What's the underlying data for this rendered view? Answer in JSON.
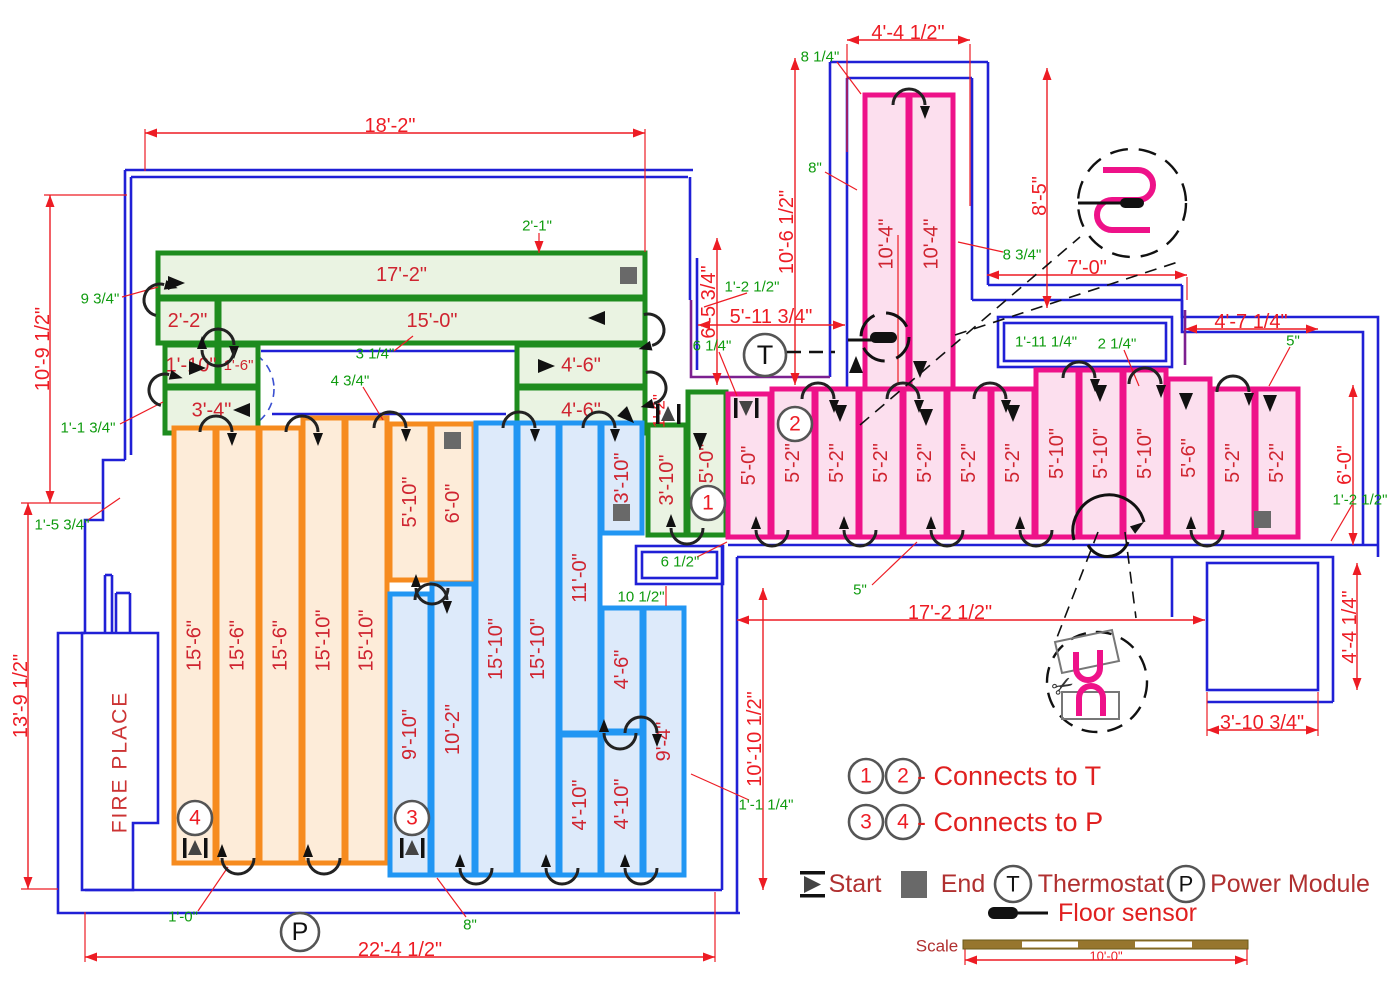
{
  "meta": {
    "width": 1400,
    "height": 1000,
    "type": "floor-heating-plan"
  },
  "colors": {
    "wall": "#2020d6",
    "purple": "#7c2090",
    "dim_red": "#ed1c24",
    "note_green": "#0f9b0f",
    "run_label": "#cf2430",
    "legend_text": "#b03030",
    "legend_red": "#e02020",
    "green_zone": "#1e8c1e",
    "green_fill": "#eaf3e2",
    "orange_zone": "#f68b1f",
    "orange_fill": "#fdecd9",
    "blue_zone": "#2196f3",
    "blue_fill": "#ddeafa",
    "pink_zone": "#ee1289",
    "pink_fill": "#fcdfee",
    "marker_gray": "#555555",
    "end_gray": "#696969",
    "scale_bar": "#97762e",
    "scale_text": "#b03030"
  },
  "fireplace": {
    "label": "FIRE PLACE",
    "x": 120,
    "y": 762
  },
  "zones": {
    "green": {
      "runs": [
        {
          "label": "17'-2\"",
          "x": 158,
          "y": 253,
          "w": 487,
          "h": 44,
          "rot": 0
        },
        {
          "label": "15'-0\"",
          "x": 219,
          "y": 299,
          "w": 426,
          "h": 44,
          "rot": 0
        },
        {
          "label": "2'-2\"",
          "x": 158,
          "y": 299,
          "w": 59,
          "h": 44,
          "rot": 0
        },
        {
          "label": "1'-10\"",
          "x": 165,
          "y": 345,
          "w": 52,
          "h": 41,
          "rot": 0
        },
        {
          "label": "1'-6\"",
          "x": 219,
          "y": 345,
          "w": 39,
          "h": 41,
          "rot": 0
        },
        {
          "label": "3'-4\"",
          "x": 165,
          "y": 388,
          "w": 93,
          "h": 45,
          "rot": 0
        },
        {
          "label": "4'-6\"",
          "x": 517,
          "y": 345,
          "w": 128,
          "h": 41,
          "rot": 0
        },
        {
          "label": "4'-6\"",
          "x": 517,
          "y": 388,
          "w": 128,
          "h": 45,
          "rot": 0
        },
        {
          "label": "3'-10\"",
          "x": 648,
          "y": 425,
          "w": 38,
          "h": 110,
          "rot": -90
        },
        {
          "label": "5'-0\"",
          "x": 688,
          "y": 392,
          "w": 38,
          "h": 143,
          "rot": -90
        }
      ]
    },
    "orange": {
      "runs": [
        {
          "label": "15'-6\"",
          "x": 174,
          "y": 428,
          "w": 41,
          "h": 435,
          "rot": -90
        },
        {
          "label": "15'-6\"",
          "x": 217,
          "y": 428,
          "w": 41,
          "h": 435,
          "rot": -90
        },
        {
          "label": "15'-6\"",
          "x": 260,
          "y": 428,
          "w": 41,
          "h": 435,
          "rot": -90
        },
        {
          "label": "15'-10\"",
          "x": 303,
          "y": 418,
          "w": 41,
          "h": 445,
          "rot": -90
        },
        {
          "label": "15'-10\"",
          "x": 346,
          "y": 418,
          "w": 41,
          "h": 445,
          "rot": -90
        },
        {
          "label": "5'-10\"",
          "x": 390,
          "y": 424,
          "w": 40,
          "h": 156,
          "rot": -90
        },
        {
          "label": "6'-0\"",
          "x": 432,
          "y": 424,
          "w": 42,
          "h": 159,
          "rot": -90
        }
      ]
    },
    "blue": {
      "runs": [
        {
          "label": "9'-10\"",
          "x": 390,
          "y": 594,
          "w": 40,
          "h": 281,
          "rot": -90
        },
        {
          "label": "10'-2\"",
          "x": 432,
          "y": 584,
          "w": 42,
          "h": 291,
          "rot": -90
        },
        {
          "label": "15'-10\"",
          "x": 476,
          "y": 423,
          "w": 40,
          "h": 452,
          "rot": -90
        },
        {
          "label": "15'-10\"",
          "x": 518,
          "y": 423,
          "w": 40,
          "h": 452,
          "rot": -90
        },
        {
          "label": "11'-0\"",
          "x": 560,
          "y": 423,
          "w": 40,
          "h": 310,
          "rot": -90
        },
        {
          "label": "4'-10\"",
          "x": 560,
          "y": 735,
          "w": 40,
          "h": 140,
          "rot": -90
        },
        {
          "label": "3'-10\"",
          "x": 602,
          "y": 423,
          "w": 40,
          "h": 110,
          "rot": -90
        },
        {
          "label": "4'-6\"",
          "x": 602,
          "y": 608,
          "w": 40,
          "h": 123,
          "rot": -90
        },
        {
          "label": "4'-10\"",
          "x": 602,
          "y": 733,
          "w": 40,
          "h": 142,
          "rot": -90
        },
        {
          "label": "9'-4\"",
          "x": 644,
          "y": 608,
          "w": 40,
          "h": 267,
          "rot": -90
        }
      ]
    },
    "pink": {
      "runs": [
        {
          "label": "10'-4\"",
          "x": 865,
          "y": 95,
          "w": 43,
          "h": 298,
          "rot": -90
        },
        {
          "label": "10'-4\"",
          "x": 910,
          "y": 95,
          "w": 43,
          "h": 298,
          "rot": -90
        },
        {
          "label": "5'-0\"",
          "x": 728,
          "y": 394,
          "w": 42,
          "h": 143,
          "rot": -90
        },
        {
          "label": "5'-2\"",
          "x": 772,
          "y": 389,
          "w": 42,
          "h": 148,
          "rot": -90
        },
        {
          "label": "5'-2\"",
          "x": 816,
          "y": 389,
          "w": 42,
          "h": 148,
          "rot": -90
        },
        {
          "label": "5'-2\"",
          "x": 860,
          "y": 389,
          "w": 42,
          "h": 148,
          "rot": -90
        },
        {
          "label": "5'-2\"",
          "x": 904,
          "y": 389,
          "w": 42,
          "h": 148,
          "rot": -90
        },
        {
          "label": "5'-2\"",
          "x": 948,
          "y": 389,
          "w": 42,
          "h": 148,
          "rot": -90
        },
        {
          "label": "5'-2\"",
          "x": 992,
          "y": 389,
          "w": 42,
          "h": 148,
          "rot": -90
        },
        {
          "label": "5'-10\"",
          "x": 1036,
          "y": 370,
          "w": 42,
          "h": 167,
          "rot": -90
        },
        {
          "label": "5'-10\"",
          "x": 1080,
          "y": 370,
          "w": 42,
          "h": 167,
          "rot": -90
        },
        {
          "label": "5'-10\"",
          "x": 1124,
          "y": 370,
          "w": 42,
          "h": 167,
          "rot": -90
        },
        {
          "label": "5'-6\"",
          "x": 1168,
          "y": 379,
          "w": 42,
          "h": 158,
          "rot": -90
        },
        {
          "label": "5'-2\"",
          "x": 1212,
          "y": 389,
          "w": 42,
          "h": 148,
          "rot": -90
        },
        {
          "label": "5'-2\"",
          "x": 1256,
          "y": 389,
          "w": 42,
          "h": 148,
          "rot": -90
        }
      ]
    }
  },
  "dimensions": [
    {
      "text": "18'-2\"",
      "x1": 145,
      "y1": 133,
      "x2": 645,
      "y2": 133,
      "lx": 390,
      "ly": 126,
      "rot": 0
    },
    {
      "text": "10'-9 1/2\"",
      "x1": 50,
      "y1": 195,
      "x2": 50,
      "y2": 503,
      "lx": 43,
      "ly": 349,
      "rot": -90
    },
    {
      "text": "13'-9 1/2\"",
      "x1": 28,
      "y1": 503,
      "x2": 28,
      "y2": 889,
      "lx": 21,
      "ly": 696,
      "rot": -90
    },
    {
      "text": "22'-4 1/2\"",
      "x1": 85,
      "y1": 957,
      "x2": 715,
      "y2": 957,
      "lx": 400,
      "ly": 950,
      "rot": 0
    },
    {
      "text": "6'-5 3/4\"",
      "x1": 717,
      "y1": 238,
      "x2": 717,
      "y2": 385,
      "lx": 709,
      "ly": 302,
      "rot": -90
    },
    {
      "text": "10'-6 1/2\"",
      "x1": 795,
      "y1": 58,
      "x2": 795,
      "y2": 385,
      "lx": 787,
      "ly": 232,
      "rot": -90
    },
    {
      "text": "5'-11 3/4\"",
      "x1": 698,
      "y1": 325,
      "x2": 845,
      "y2": 325,
      "lx": 771,
      "ly": 317,
      "rot": 0
    },
    {
      "text": "4'-4 1/2\"",
      "x1": 847,
      "y1": 40,
      "x2": 970,
      "y2": 40,
      "lx": 908,
      "ly": 33,
      "rot": 0
    },
    {
      "text": "8'-5\"",
      "x1": 1047,
      "y1": 68,
      "x2": 1047,
      "y2": 308,
      "lx": 1040,
      "ly": 196,
      "rot": -90
    },
    {
      "text": "7'-0\"",
      "x1": 987,
      "y1": 275,
      "x2": 1187,
      "y2": 275,
      "lx": 1087,
      "ly": 268,
      "rot": 0
    },
    {
      "text": "4'-7 1/4\"",
      "x1": 1185,
      "y1": 329,
      "x2": 1318,
      "y2": 329,
      "lx": 1251,
      "ly": 322,
      "rot": 0
    },
    {
      "text": "6'-0\"",
      "x1": 1353,
      "y1": 385,
      "x2": 1353,
      "y2": 545,
      "lx": 1345,
      "ly": 465,
      "rot": -90
    },
    {
      "text": "4'-4 1/4\"",
      "x1": 1357,
      "y1": 563,
      "x2": 1357,
      "y2": 690,
      "lx": 1350,
      "ly": 627,
      "rot": -90
    },
    {
      "text": "3'-10 3/4\"",
      "x1": 1207,
      "y1": 730,
      "x2": 1318,
      "y2": 730,
      "lx": 1262,
      "ly": 723,
      "rot": 0
    },
    {
      "text": "17'-2 1/2\"",
      "x1": 737,
      "y1": 620,
      "x2": 1205,
      "y2": 620,
      "lx": 950,
      "ly": 613,
      "rot": 0
    },
    {
      "text": "10'-10 1/2\"",
      "x1": 763,
      "y1": 588,
      "x2": 763,
      "y2": 890,
      "lx": 755,
      "ly": 739,
      "rot": -90
    },
    {
      "text": "10'-0\"",
      "x1": 965,
      "y1": 960,
      "x2": 1247,
      "y2": 960,
      "lx": 1106,
      "ly": 956,
      "rot": 0,
      "small": true
    }
  ],
  "red_notes": [
    {
      "text": "1'-2\"",
      "x": 659,
      "y": 411,
      "rot": -90
    }
  ],
  "green_notes": [
    {
      "text": "2'-1\"",
      "x": 537,
      "y": 226,
      "leader": [
        539,
        233,
        539,
        253
      ]
    },
    {
      "text": "9 3/4\"",
      "x": 100,
      "y": 299,
      "leader": [
        122,
        297,
        158,
        287
      ]
    },
    {
      "text": "1'-1 3/4\"",
      "x": 88,
      "y": 428,
      "leader": [
        120,
        424,
        163,
        402
      ]
    },
    {
      "text": "1'-5 3/4\"",
      "x": 62,
      "y": 525,
      "leader": [
        88,
        520,
        120,
        498
      ]
    },
    {
      "text": "1'-0\"",
      "x": 183,
      "y": 917,
      "leader": [
        198,
        911,
        228,
        867
      ]
    },
    {
      "text": "8\"",
      "x": 470,
      "y": 925,
      "leader": [
        466,
        917,
        437,
        878
      ]
    },
    {
      "text": "6 1/2\"",
      "x": 680,
      "y": 562,
      "leader": [
        697,
        557,
        727,
        542
      ]
    },
    {
      "text": "10 1/2\"",
      "x": 641,
      "y": 597,
      "leader": [
        666,
        586,
        666,
        606
      ]
    },
    {
      "text": "5\"",
      "x": 860,
      "y": 590,
      "leader": [
        872,
        585,
        917,
        542
      ]
    },
    {
      "text": "3 1/4\"",
      "x": 375,
      "y": 354,
      "leader": [
        394,
        351,
        413,
        336
      ]
    },
    {
      "text": "4 3/4\"",
      "x": 350,
      "y": 381,
      "leader": [
        363,
        387,
        383,
        420
      ]
    },
    {
      "text": "1'-2 1/2\"",
      "x": 752,
      "y": 287,
      "leader": [
        747,
        293,
        704,
        307
      ]
    },
    {
      "text": "6 1/4\"",
      "x": 712,
      "y": 346,
      "leader": [
        719,
        352,
        737,
        396
      ]
    },
    {
      "text": "8 1/4\"",
      "x": 820,
      "y": 57,
      "leader": [
        837,
        62,
        861,
        94
      ]
    },
    {
      "text": "8\"",
      "x": 815,
      "y": 168,
      "leader": [
        825,
        172,
        857,
        190
      ]
    },
    {
      "text": "8 3/4\"",
      "x": 1022,
      "y": 255,
      "leader": [
        1003,
        252,
        958,
        242
      ]
    },
    {
      "text": "1'-11 1/4\"",
      "x": 1046,
      "y": 342,
      "leader": null
    },
    {
      "text": "2 1/4\"",
      "x": 1117,
      "y": 344,
      "leader": [
        1124,
        350,
        1139,
        386
      ]
    },
    {
      "text": "5\"",
      "x": 1293,
      "y": 341,
      "leader": [
        1290,
        347,
        1269,
        386
      ]
    },
    {
      "text": "1'-2 1/2\"",
      "x": 1360,
      "y": 500,
      "leader": [
        1352,
        505,
        1331,
        541
      ]
    },
    {
      "text": "1'-1 1/4\"",
      "x": 766,
      "y": 805,
      "leader": [
        749,
        800,
        691,
        774
      ]
    }
  ],
  "markers": {
    "circled_numbers": [
      {
        "n": "1",
        "x": 708,
        "y": 503
      },
      {
        "n": "2",
        "x": 795,
        "y": 424
      },
      {
        "n": "3",
        "x": 412,
        "y": 818
      },
      {
        "n": "4",
        "x": 195,
        "y": 818
      }
    ],
    "thermostat": {
      "symbol": "T",
      "x": 765,
      "y": 355
    },
    "power": {
      "symbol": "P",
      "x": 300,
      "y": 932
    },
    "starts": [
      {
        "x": 195,
        "y": 848,
        "dir": "up"
      },
      {
        "x": 412,
        "y": 848,
        "dir": "up"
      },
      {
        "x": 746,
        "y": 408,
        "dir": "down"
      },
      {
        "x": 668,
        "y": 414,
        "dir": "up"
      }
    ],
    "ends": [
      {
        "x": 620,
        "y": 267
      },
      {
        "x": 444,
        "y": 432
      },
      {
        "x": 613,
        "y": 504
      },
      {
        "x": 1254,
        "y": 511
      }
    ]
  },
  "legend": {
    "row1": {
      "circles": [
        "1",
        "2"
      ],
      "text": "- Connects to T",
      "cx": [
        866,
        903
      ],
      "cy": 776,
      "tx": 917,
      "ty": 776
    },
    "row2": {
      "circles": [
        "3",
        "4"
      ],
      "text": "- Connects to P",
      "cx": [
        866,
        903
      ],
      "cy": 822,
      "tx": 917,
      "ty": 822
    },
    "start_label": "Start",
    "end_label": "End",
    "thermostat_label": "Thermostat",
    "thermostat_symbol": "T",
    "power_label": "Power Module",
    "power_symbol": "P",
    "sensor_label": "Floor sensor",
    "scale_label": "Scale",
    "scale_value": "10'-0\""
  }
}
